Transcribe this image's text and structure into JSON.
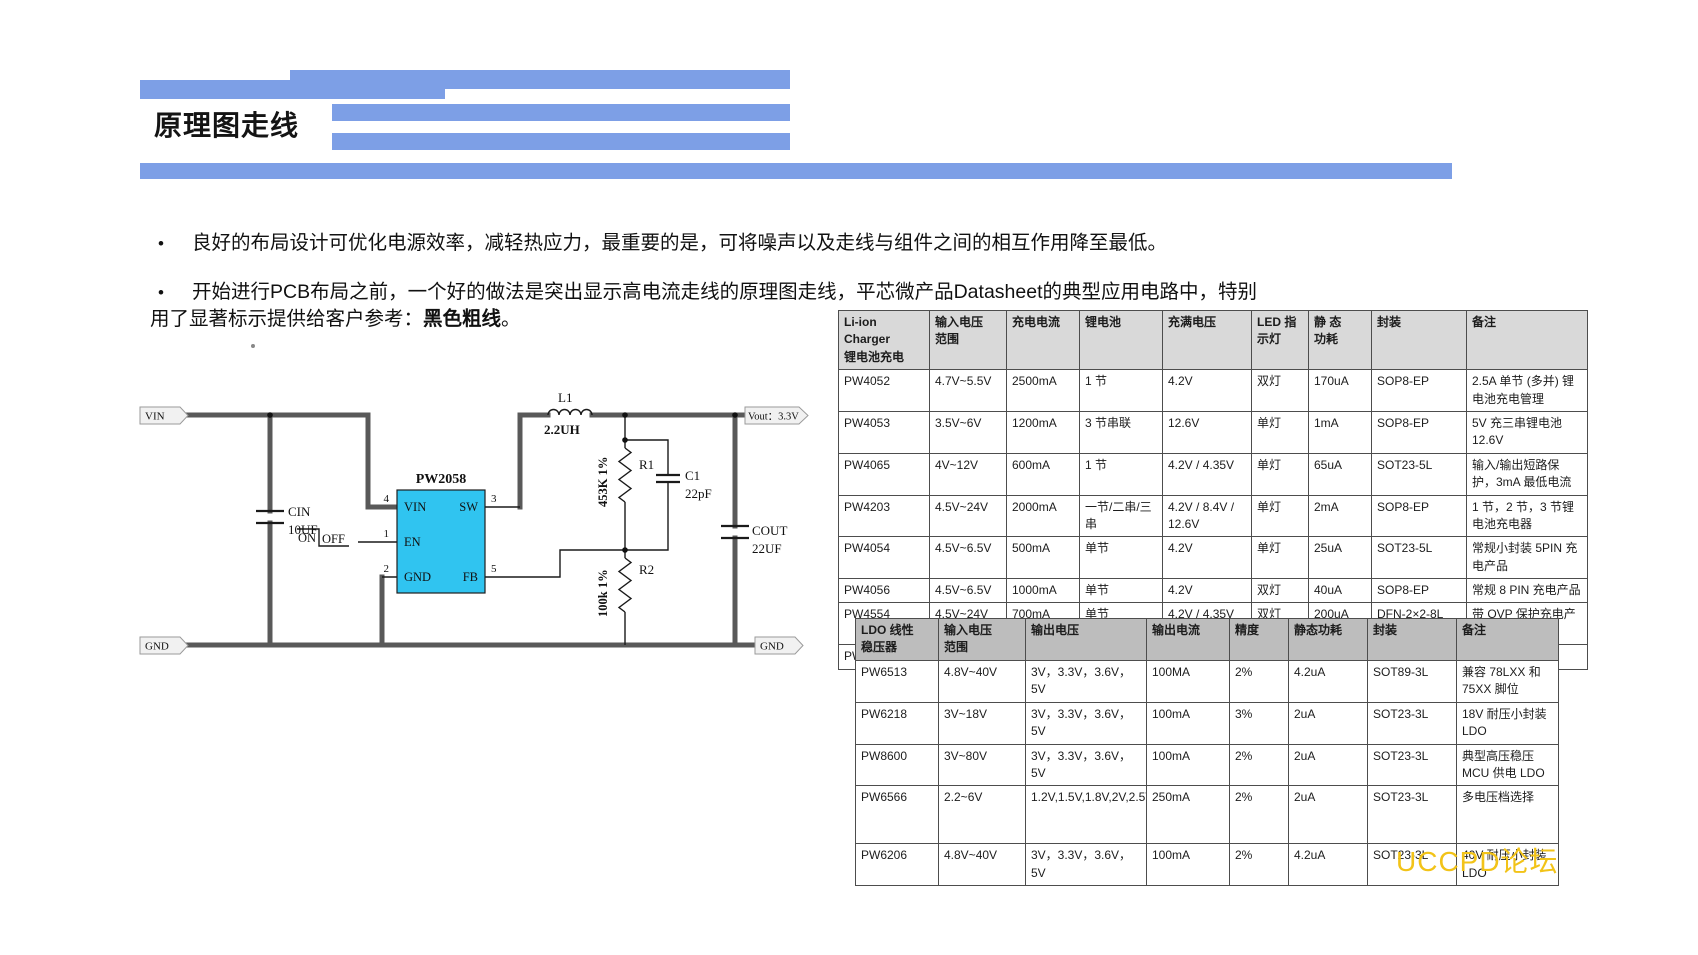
{
  "page": {
    "title": "原理图走线",
    "watermark": "UCCPD论坛"
  },
  "colors": {
    "accent_bar": "#7D9FE6",
    "chip_fill": "#30C4F0",
    "watermark": "#F2C318",
    "table1_header_bg": "#D9D9D9",
    "table2_header_bg": "#BDBDBD",
    "thick_trace": "#595959"
  },
  "bullets": {
    "marker": "•",
    "b1": "良好的布局设计可优化电源效率，减轻热应力，最重要的是，可将噪声以及走线与组件之间的相互作用降至最低。",
    "b2_line1": "开始进行PCB布局之前，一个好的做法是突出显示高电流走线的原理图走线，平芯微产品Datasheet的典型应用电路中，特别",
    "b2_line2_pre": "用了显著标示提供给客户参考：",
    "b2_bold": "黑色粗线",
    "b2_end": "。"
  },
  "schematic": {
    "ports": {
      "vin": "VIN",
      "vout": "Vout：3.3V",
      "gnd_left": "GND",
      "gnd_right": "GND"
    },
    "chip": {
      "name": "PW2058",
      "pin_labels": [
        "VIN",
        "SW",
        "EN",
        "GND",
        "FB"
      ],
      "pin_numbers": [
        "4",
        "3",
        "1",
        "2",
        "5"
      ]
    },
    "components": {
      "cin": {
        "ref": "CIN",
        "value": "10UF"
      },
      "l1": {
        "ref": "L1",
        "value": "2.2UH"
      },
      "c1": {
        "ref": "C1",
        "value": "22pF"
      },
      "r1": {
        "ref": "R1",
        "value": "453K 1%"
      },
      "r2": {
        "ref": "R2",
        "value": "100k 1%"
      },
      "cout": {
        "ref": "COUT",
        "value": "22UF"
      }
    },
    "enable": {
      "on": "ON",
      "off": "OFF"
    }
  },
  "tables": [
    {
      "headers": [
        "Li-ion\nCharger\n锂电池充电",
        "输入电压\n范围",
        "充电电流",
        "锂电池",
        "充满电压",
        "LED 指\n示灯",
        "静 态\n功耗",
        "封装",
        "备注"
      ],
      "col_widths": [
        80,
        66,
        62,
        72,
        78,
        46,
        52,
        84,
        110
      ],
      "rows": [
        [
          "PW4052",
          "4.7V~5.5V",
          "2500mA",
          "1 节",
          "4.2V",
          "双灯",
          "170uA",
          "SOP8-EP",
          "2.5A 单节 (多并) 锂电池充电管理"
        ],
        [
          "PW4053",
          "3.5V~6V",
          "1200mA",
          "3 节串联",
          "12.6V",
          "单灯",
          "1mA",
          "SOP8-EP",
          "5V 充三串锂电池 12.6V"
        ],
        [
          "PW4065",
          "4V~12V",
          "600mA",
          "1 节",
          "4.2V / 4.35V",
          "单灯",
          "65uA",
          "SOT23-5L",
          "输入/输出短路保护，3mA 最低电流"
        ],
        [
          "PW4203",
          "4.5V~24V",
          "2000mA",
          "一节/二串/三串",
          "4.2V / 8.4V / 12.6V",
          "单灯",
          "2mA",
          "SOP8-EP",
          "1 节，2 节，3 节锂电池充电器"
        ],
        [
          "PW4054",
          "4.5V~6.5V",
          "500mA",
          "单节",
          "4.2V",
          "单灯",
          "25uA",
          "SOT23-5L",
          "常规小封装 5PIN 充电产品"
        ],
        [
          "PW4056",
          "4.5V~6.5V",
          "1000mA",
          "单节",
          "4.2V",
          "双灯",
          "40uA",
          "SOP8-EP",
          "常规 8 PIN 充电产品"
        ],
        [
          "PW4554",
          "4.5V~24V",
          "700mA",
          "单节",
          "4.2V / 4.35V",
          "双灯",
          "200uA",
          "DFN-2×2-8L",
          "带 OVP 保护充电产品"
        ],
        [
          "PW4556",
          "4.5V~5.5V",
          "250mA",
          "单节",
          "4.2V / 4.35V",
          "单灯",
          "2.4uA",
          "TDFN1X1-6L",
          "体积小充电产品"
        ]
      ]
    },
    {
      "headers": [
        "LDO 线性\n稳压器",
        "输入电压\n范围",
        "输出电压",
        "输出电流",
        "精度",
        "静态功耗",
        "封装",
        "备注"
      ],
      "col_widths": [
        72,
        76,
        110,
        72,
        48,
        68,
        78,
        91
      ],
      "rows": [
        [
          "PW6513",
          "4.8V~40V",
          "3V，3.3V，3.6V，5V",
          "100MA",
          "2%",
          "4.2uA",
          "SOT89-3L",
          "兼容 78LXX 和 75XX 脚位"
        ],
        [
          "PW6218",
          "3V~18V",
          "3V，3.3V，3.6V，5V",
          "100mA",
          "3%",
          "2uA",
          "SOT23-3L",
          "18V 耐压小封装 LDO"
        ],
        [
          "PW8600",
          "3V~80V",
          "3V，3.3V，3.6V，5V",
          "100mA",
          "2%",
          "2uA",
          "SOT23-3L",
          "典型高压稳压 MCU 供电 LDO"
        ],
        [
          "PW6566",
          "2.2~6V",
          "1.2V,1.5V,1.8V,2V,2.5V,2.8V,3V,3.3V,3.6V,5V",
          "250mA",
          "2%",
          "2uA",
          "SOT23-3L",
          "多电压档选择"
        ],
        [
          "PW6206",
          "4.8V~40V",
          "3V，3.3V，3.6V，5V",
          "100mA",
          "2%",
          "4.2uA",
          "SOT23-3L",
          "40V 耐压小封装 LDO"
        ]
      ]
    }
  ]
}
